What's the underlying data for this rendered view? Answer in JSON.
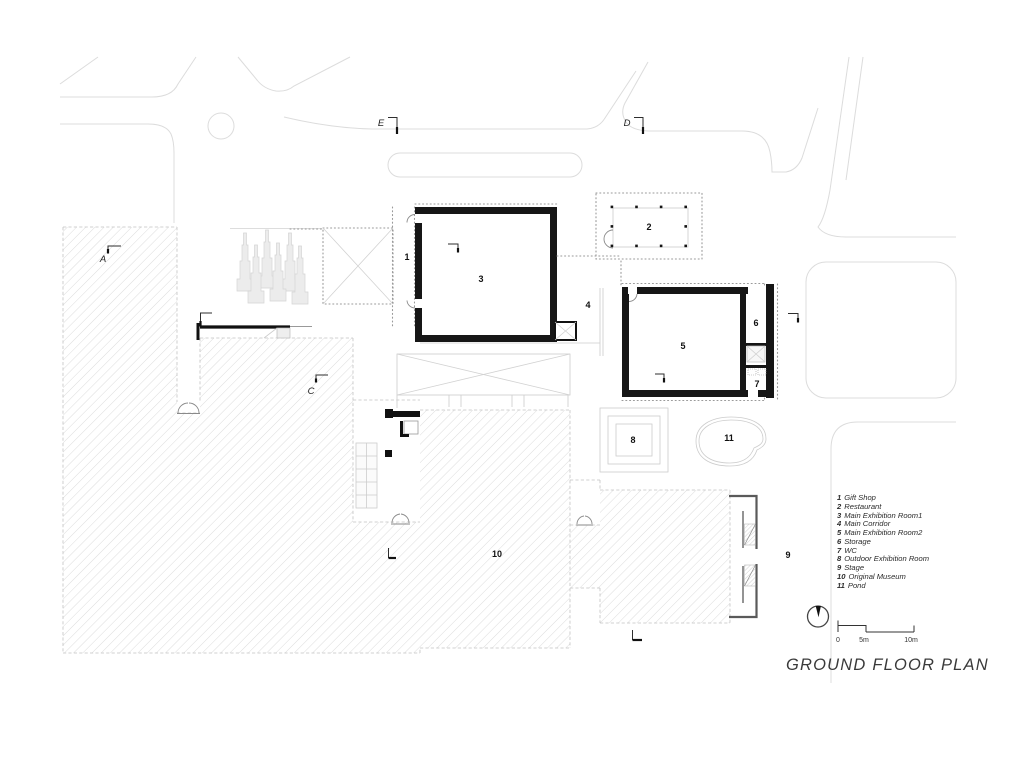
{
  "title": "GROUND FLOOR PLAN",
  "plan_labels": {
    "n1": "1",
    "n2": "2",
    "n3": "3",
    "n4": "4",
    "n5": "5",
    "n6": "6",
    "n7": "7",
    "n8": "8",
    "n9": "9",
    "n10": "10",
    "n11": "11"
  },
  "section_markers": {
    "a": "A",
    "c": "C",
    "d": "D",
    "e": "E"
  },
  "legend": {
    "items": [
      {
        "num": "1",
        "name": "Gift Shop"
      },
      {
        "num": "2",
        "name": "Restaurant"
      },
      {
        "num": "3",
        "name": "Main Exhibition Room1"
      },
      {
        "num": "4",
        "name": "Main Corridor"
      },
      {
        "num": "5",
        "name": "Main Exhibition Room2"
      },
      {
        "num": "6",
        "name": "Storage"
      },
      {
        "num": "7",
        "name": "WC"
      },
      {
        "num": "8",
        "name": "Outdoor Exhibition Room"
      },
      {
        "num": "9",
        "name": "Stage"
      },
      {
        "num": "10",
        "name": "Original Museum"
      },
      {
        "num": "11",
        "name": "Pond"
      }
    ]
  },
  "scale_bar": {
    "zero": "0",
    "five": "5m",
    "ten": "10m"
  },
  "colors": {
    "wall": "#161616",
    "ink": "#2e2e2e",
    "road": "#dcdcdc",
    "hatch": "#d8d8d8",
    "title_text": "#3a3a3a"
  }
}
